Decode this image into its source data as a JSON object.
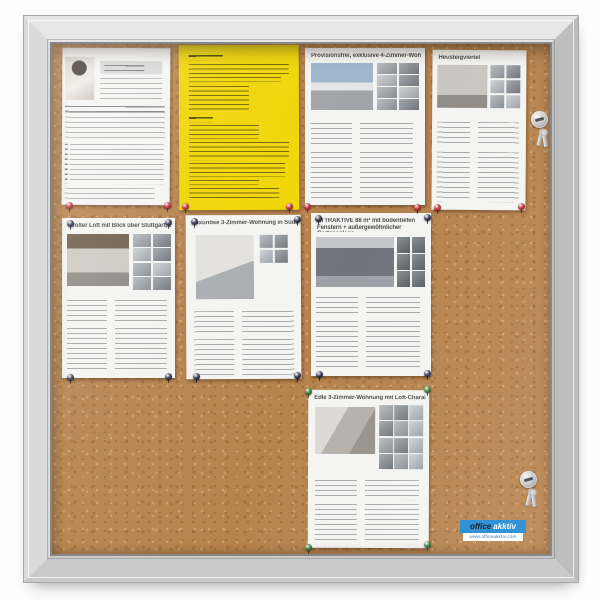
{
  "colors": {
    "frame_silver": "#cfcfcf",
    "cork": "#b7834d",
    "paper_white": "#f4f4f2",
    "paper_yellow": "#efd503",
    "pin_red": "#c23038",
    "pin_navy": "#3a3e55",
    "pin_green": "#3f8440",
    "logo_blue": "#1f8ad2"
  },
  "icons": {
    "lock": "cam-lock-icon",
    "keys": "key-ring-icon",
    "pushpin": "pushpin-icon"
  },
  "papers": [
    {
      "key": "info-sheet",
      "title": ""
    },
    {
      "key": "yellow-notice",
      "title": ""
    },
    {
      "key": "listing-4-zimmer",
      "title": "Provisionsfrei, exklusive 4-Zimmer-Wohnung"
    },
    {
      "key": "listing-heusteigviertel",
      "title": "Heusteigviertel"
    },
    {
      "key": "listing-loft-stuttgart",
      "title": "Großer Loft mit Blick über Stuttgart, Gänsheide"
    },
    {
      "key": "listing-suedlage",
      "title": "Luxuriöse 3-Zimmer-Wohnung in Südlage"
    },
    {
      "key": "listing-88qm",
      "title": "ATTRAKTIVE 88 m² mit bodentiefen Fenstern + außergewöhnlicher Gartenanlage"
    },
    {
      "key": "listing-loft-charakter",
      "title": "Edle 3-Zimmer-Wohnung mit Loft-Charakter"
    }
  ],
  "logo": {
    "brand_bold": "office",
    "brand_italic": "akktiv",
    "website": "www.officeakktiv.com"
  }
}
